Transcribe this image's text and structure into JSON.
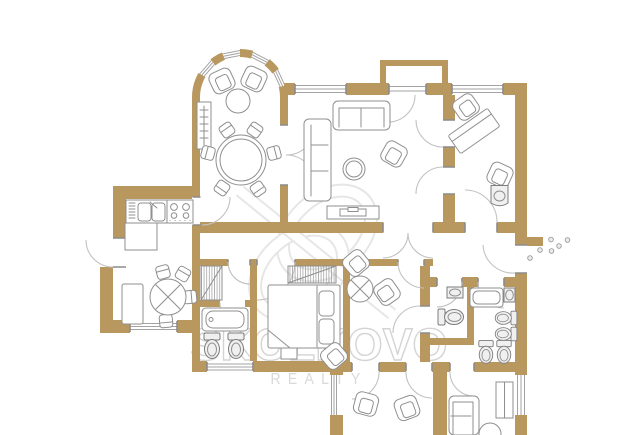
{
  "watermark": {
    "brand": "SKOLKOVO",
    "tagline": "REALTY",
    "logo": "skolkovo-s-monogram"
  },
  "colors": {
    "background": "#ffffff",
    "wall": "#b8985e",
    "wall_light": "#dbc49a",
    "furniture_line": "#8f8f8f",
    "fixture_line": "#7d7d7d",
    "window_line": "#a3a3a3",
    "door_arc": "#c2c2c2",
    "jamb": "#8c8c8c",
    "watermark": "#e6e6e6",
    "watermark_text": "#d4d4d4",
    "tagline": "#d9d9d9",
    "dot_fill": "#ececec",
    "dot_line": "#9a9a9a"
  },
  "plan": {
    "type": "apartment-floor-plan",
    "legend": [
      "bay-window",
      "balcony",
      "window",
      "door-swing",
      "entrance-door",
      "entrance-dots",
      "armchair",
      "sofa",
      "pouf",
      "round-table",
      "dining-table",
      "chair",
      "bench",
      "kitchen-counter",
      "kitchen-sink",
      "stove",
      "dishwasher",
      "fridge",
      "bathtub",
      "toilet",
      "washbasin",
      "corner-sink",
      "bed",
      "wardrobe-hatched",
      "desk",
      "media-console",
      "shelf-unit"
    ]
  }
}
